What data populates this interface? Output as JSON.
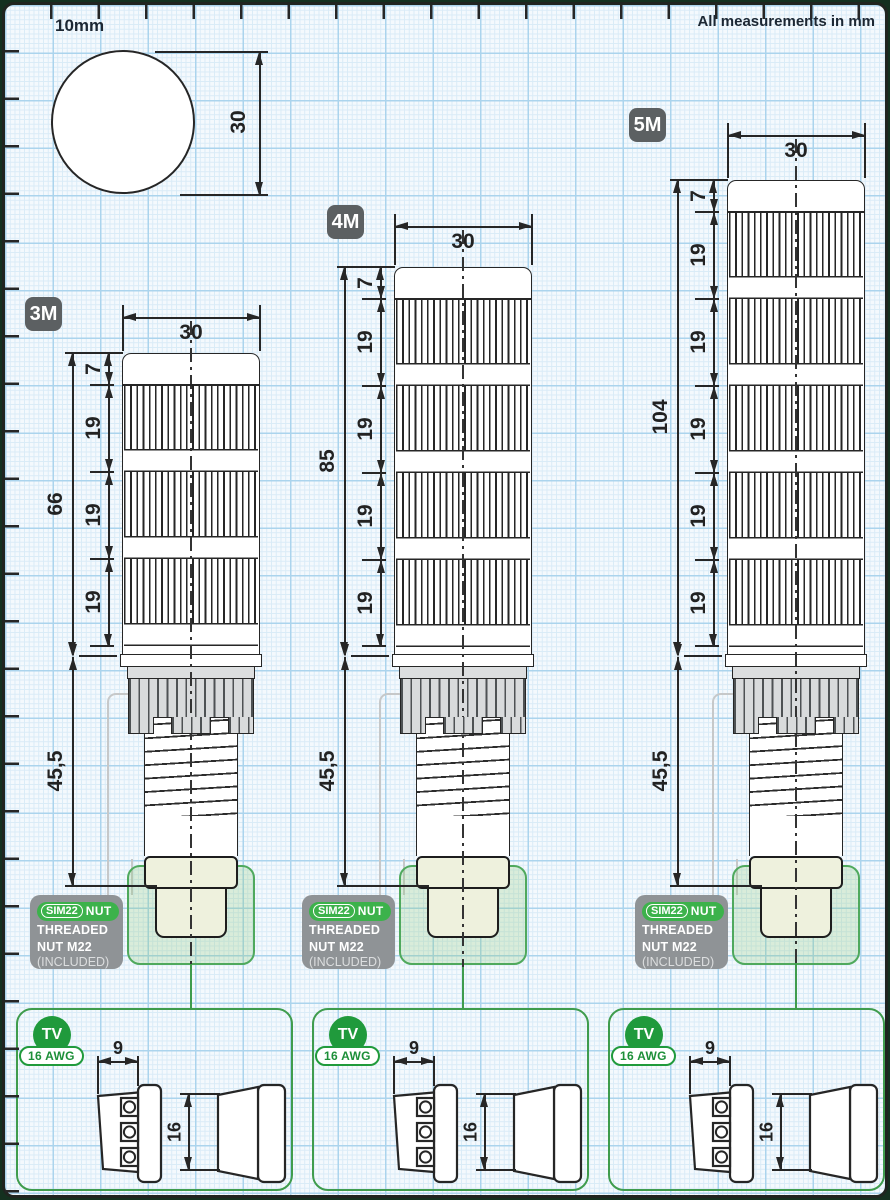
{
  "page": {
    "ruler_label": "10mm",
    "units_note": "All measurements in mm"
  },
  "lens_detail": {
    "diameter": "30"
  },
  "towers": [
    {
      "badge": "3M",
      "width": "30",
      "cap": "7",
      "modules": [
        "19",
        "19",
        "19"
      ],
      "overall": "66",
      "base": "45,5",
      "nut_badge": {
        "brand": "SIM22",
        "suffix": "NUT",
        "line1": "THREADED",
        "line2": "NUT M22",
        "line3": "(INCLUDED)"
      }
    },
    {
      "badge": "4M",
      "width": "30",
      "cap": "7",
      "modules": [
        "19",
        "19",
        "19",
        "19"
      ],
      "overall": "85",
      "base": "45,5",
      "nut_badge": {
        "brand": "SIM22",
        "suffix": "NUT",
        "line1": "THREADED",
        "line2": "NUT M22",
        "line3": "(INCLUDED)"
      }
    },
    {
      "badge": "5M",
      "width": "30",
      "cap": "7",
      "modules": [
        "19",
        "19",
        "19",
        "19",
        "19"
      ],
      "overall": "104",
      "base": "45,5",
      "nut_badge": {
        "brand": "SIM22",
        "suffix": "NUT",
        "line1": "THREADED",
        "line2": "NUT M22",
        "line3": "(INCLUDED)"
      }
    }
  ],
  "connector_boxes": [
    {
      "badge": "TV",
      "gauge": "16 AWG",
      "width": "9",
      "height": "16"
    },
    {
      "badge": "TV",
      "gauge": "16 AWG",
      "width": "9",
      "height": "16"
    },
    {
      "badge": "TV",
      "gauge": "16 AWG",
      "width": "9",
      "height": "16"
    }
  ],
  "colors": {
    "accent_green": "#3f9c4d",
    "badge_gray": "#5c6062",
    "nut_badge_gray": "#8f9396",
    "nut_fill": "#eef1dd",
    "grid_major": "#abd4ed",
    "grid_minor": "#d9ebf7"
  }
}
